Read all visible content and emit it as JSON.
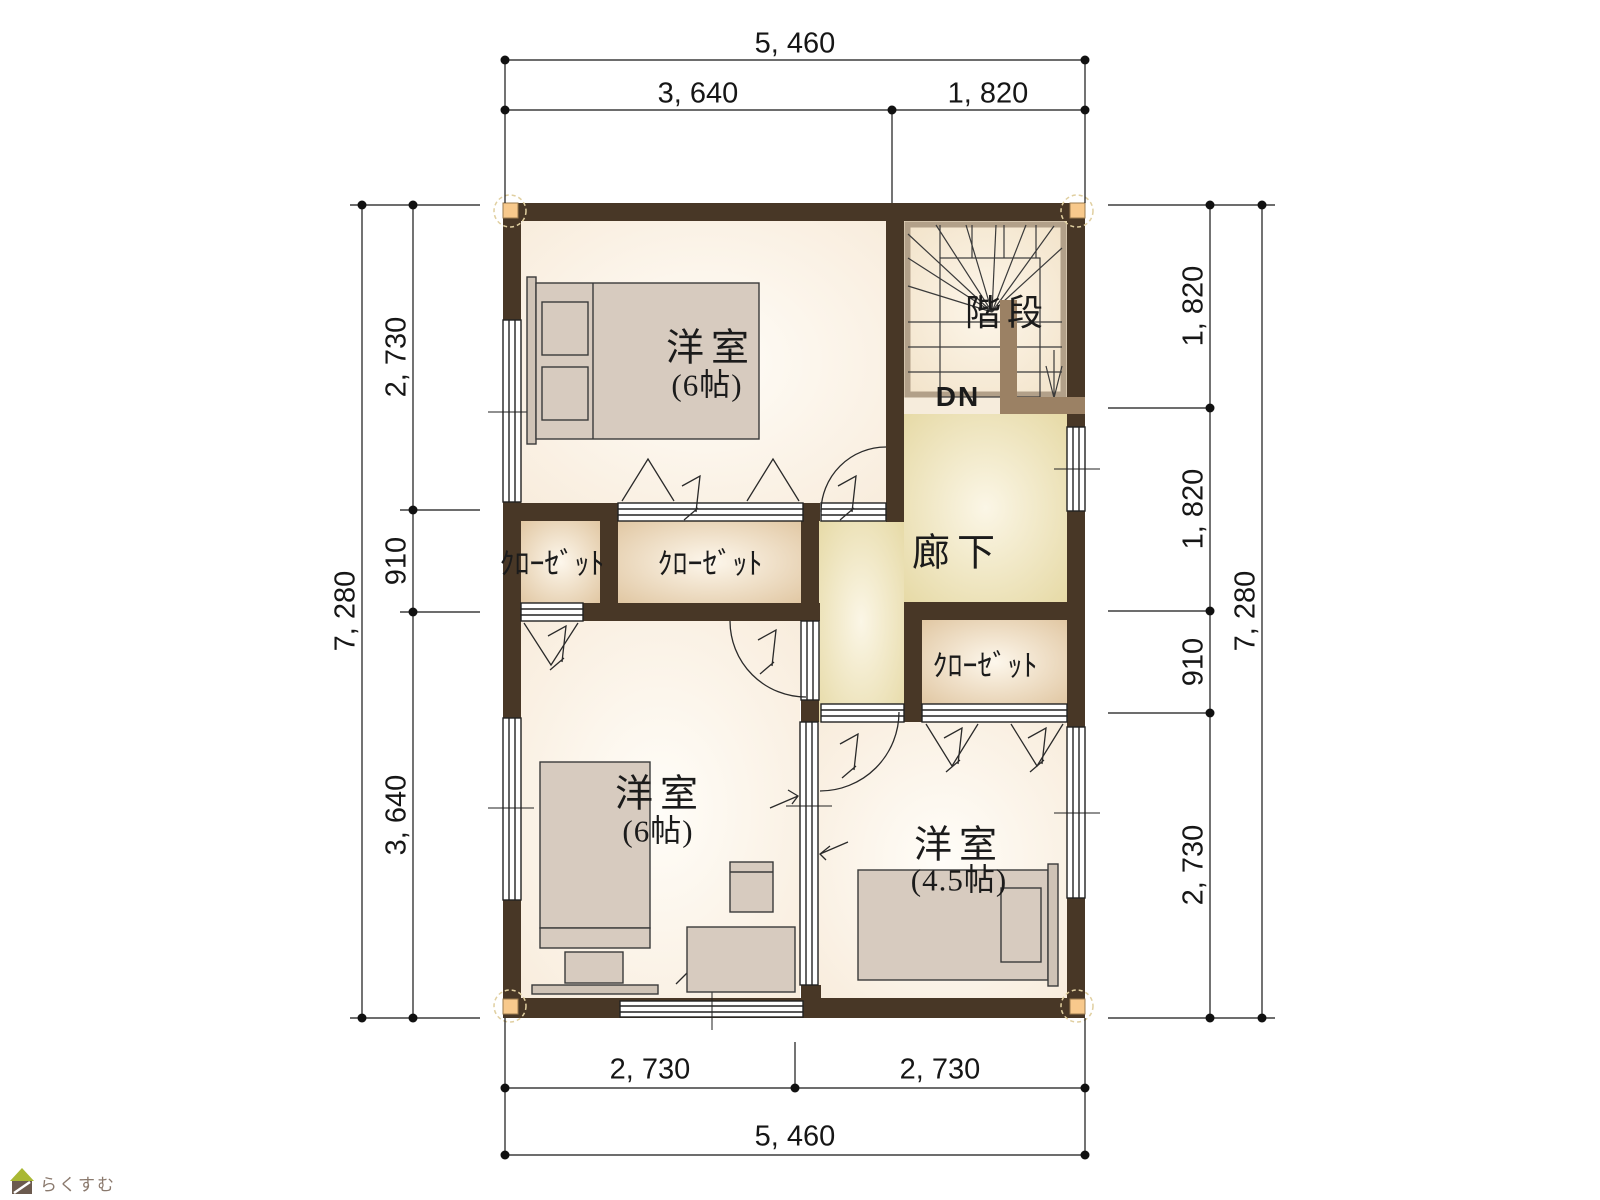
{
  "floorplan": {
    "rooms": {
      "bedroom_top": {
        "label": "洋室",
        "size": "(6帖)"
      },
      "bedroom_bottom_left": {
        "label": "洋室",
        "size": "(6帖)"
      },
      "bedroom_bottom_right": {
        "label": "洋室",
        "size": "(4.5帖)"
      },
      "stairs": {
        "label": "階段",
        "direction": "DN"
      },
      "hallway": {
        "label": "廊下"
      },
      "closet_left": {
        "label": "ｸﾛｰｾﾞｯﾄ"
      },
      "closet_middle": {
        "label": "ｸﾛｰｾﾞｯﾄ"
      },
      "closet_right": {
        "label": "ｸﾛｰｾﾞｯﾄ"
      }
    },
    "dimensions": {
      "top": {
        "overall": "5, 460",
        "segments": [
          "3, 640",
          "1, 820"
        ]
      },
      "bottom": {
        "overall": "5, 460",
        "segments": [
          "2, 730",
          "2, 730"
        ]
      },
      "left": {
        "overall": "7, 280",
        "segments": [
          "2, 730",
          "910",
          "3, 640"
        ]
      },
      "right": {
        "overall": "7, 280",
        "segments": [
          "1, 820",
          "1, 820",
          "910",
          "2, 730"
        ]
      }
    },
    "colors": {
      "wall": "#483726",
      "room_floor": "#f8ecdc",
      "hall_floor": "#e5d8a2",
      "closet_floor": "#dfc49e",
      "stair_floor": "#f1e1c6",
      "railing": "#9b8164",
      "corner_marker": "#f8c98c"
    }
  },
  "branding": {
    "logo_text": "らくすむ"
  }
}
